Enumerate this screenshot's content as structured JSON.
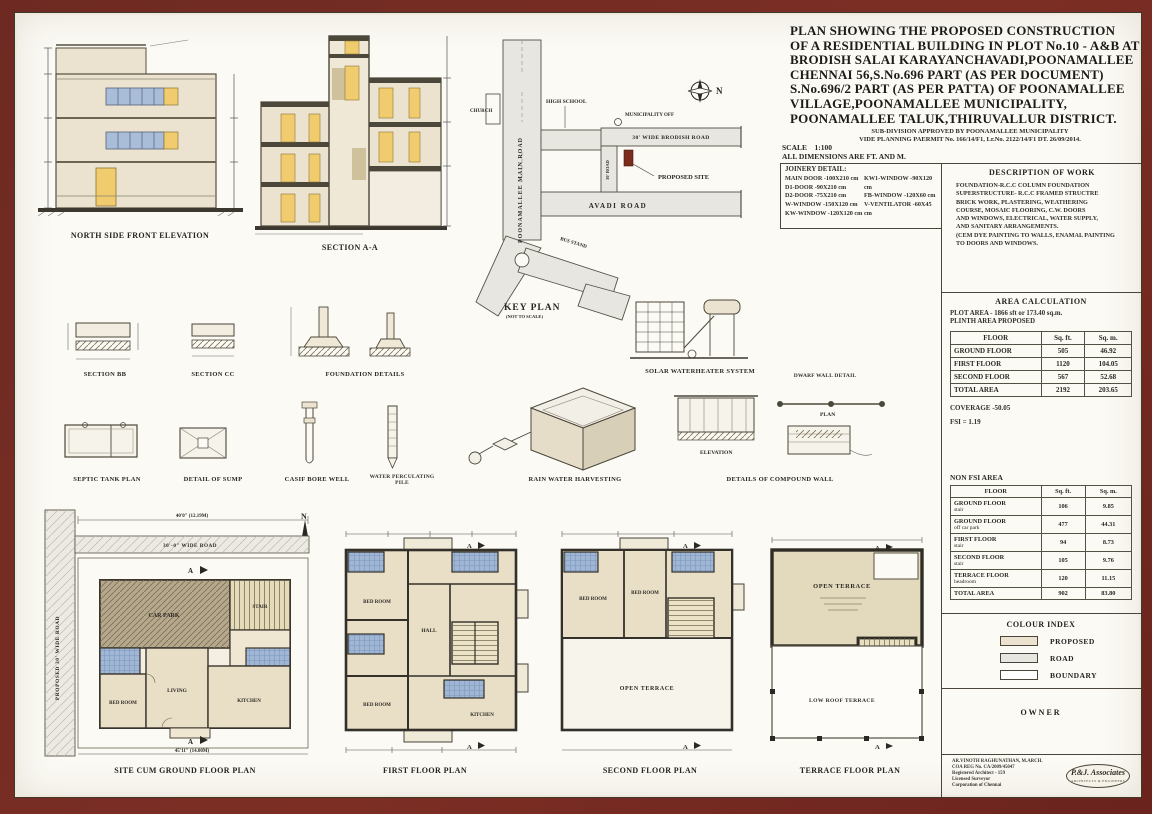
{
  "colors": {
    "frame": "#6e2a22",
    "sheet": "#fbfaf4",
    "cream": "#ebe3cf",
    "window_blue": "#a9bdd9",
    "door_yellow": "#f0cc6e",
    "road_gray": "#e7e6e1",
    "site_marker": "#7c2b1d",
    "room_tan": "#e9dfc6",
    "bath_blue": "#9fb6d4",
    "carpark": "#b5a88c",
    "wall_ink": "#333333"
  },
  "title_block": {
    "title_lines": [
      "PLAN SHOWING THE PROPOSED CONSTRUCTION",
      "OF A RESIDENTIAL BUILDING IN PLOT No.10 - A&B  AT",
      "BRODISH SALAI KARAYANCHAVADI,POONAMALLEE",
      "CHENNAI 56,S.No.696 PART (AS PER DOCUMENT)",
      "S.No.696/2 PART (AS PER PATTA) OF POONAMALLEE",
      "VILLAGE,POONAMALLEE MUNICIPALITY,",
      "POONAMALLEE TALUK,THIRUVALLUR DISTRICT."
    ],
    "subdivision_line1": "SUB-DIVISION APPROVED BY POONAMALLEE MUNICIPALITY",
    "subdivision_line2": "VIDE PLANNING PAERMIT No. 166/14/F1, Lr.No. 2122/14/F1 DT. 26/09/2014.",
    "scale_label": "SCALE",
    "scale_value": "1:100",
    "dims_note": "ALL DIMENSIONS ARE FT. AND M.",
    "joinery": {
      "heading": "JOINERY DETAIL:",
      "left": [
        "MAIN DOOR -100X210 cm",
        "D1-DOOR -90X210 cm",
        "D2-DOOR -75X210 cm",
        "W-WINDOW -150X120 cm",
        "KW-WINDOW -120X120 cm"
      ],
      "right": [
        "KW1-WINDOW -90X120 cm",
        "FB-WINDOW -120X60 cm",
        "V-VENTILATOR -60X45 cm"
      ]
    },
    "description": {
      "heading": "DESCRIPTION OF WORK",
      "lines": [
        "FOUNDATION-R.C.C COLUMN FOUNDATION",
        "SUPERSTRUCTURE- R.C.C FRAMED STRUCTRE",
        "BRICK WORK, PLASTERING, WEATHERING",
        "COURSE, MOSAIC FLOORING, C.W. DOORS",
        "AND WINDOWS, ELECTRICAL, WATER SUPPLY,",
        "AND SANITARY ARRANGEMENTS.",
        "(CEM DYE PAINTING TO WALLS, ENAMAL PAINTING",
        "TO DOORS AND WINDOWS."
      ]
    },
    "area_calc": {
      "heading": "AREA CALCULATION",
      "plot_area": "PLOT AREA - 1866 sft  or 173.40 sq.m.",
      "plinth": "PLINTH AREA PROPOSED",
      "headers": [
        "FLOOR",
        "Sq. ft.",
        "Sq. m."
      ],
      "rows": [
        [
          "GROUND FLOOR",
          "505",
          "46.92"
        ],
        [
          "FIRST FLOOR",
          "1120",
          "104.05"
        ],
        [
          "SECOND FLOOR",
          "567",
          "52.68"
        ],
        [
          "TOTAL AREA",
          "2192",
          "203.65"
        ]
      ],
      "coverage": "COVERAGE -50.05",
      "fsi": "FSI = 1.19"
    },
    "non_fsi": {
      "heading": "NON FSI AREA",
      "headers": [
        "FLOOR",
        "Sq. ft.",
        "Sq. m."
      ],
      "rows": [
        {
          "floor": "GROUND FLOOR",
          "sub": "stair",
          "sqft": "106",
          "sqm": "9.85"
        },
        {
          "floor": "GROUND FLOOR",
          "sub": "off car park",
          "sqft": "477",
          "sqm": "44.31"
        },
        {
          "floor": "FIRST FLOOR",
          "sub": "stair",
          "sqft": "94",
          "sqm": "8.73"
        },
        {
          "floor": "SECOND FLOOR",
          "sub": "stair",
          "sqft": "105",
          "sqm": "9.76"
        },
        {
          "floor": "TERRACE FLOOR",
          "sub": "headroom",
          "sqft": "120",
          "sqm": "11.15"
        },
        {
          "floor": "TOTAL AREA",
          "sub": "",
          "sqft": "902",
          "sqm": "83.80"
        }
      ]
    },
    "colour_index": {
      "heading": "COLOUR INDEX",
      "items": [
        {
          "label": "PROPOSED",
          "color": "#ebe3cf"
        },
        {
          "label": "ROAD",
          "color": "#e7e6e1"
        },
        {
          "label": "BOUNDARY",
          "color": "#ffffff"
        }
      ]
    },
    "owner_heading": "OWNER",
    "architect": {
      "lines": [
        "AR.VINOTH RAGHUNATHAN, M.ARCH.",
        "COA REG No. CA/2009/45047",
        "Registered Architect - 159",
        "Licensed Surveyor",
        "Corporation of Chennai"
      ],
      "logo_text": "P.&J. Associates",
      "logo_sub": "ARCHITECTS & ENGINEERS"
    }
  },
  "drawings": {
    "elevation_label": "NORTH SIDE FRONT ELEVATION",
    "section_aa_label": "SECTION A-A",
    "key_plan": {
      "label": "KEY PLAN",
      "sublabel": "(NOT TO SCALE)",
      "north": "N",
      "road_main": "POONAMALLEE MAIN ROAD",
      "road_avadi": "AVADI ROAD",
      "road_brodish": "30' WIDE BRODISH ROAD",
      "road_cross": "30' ROAD",
      "poi_church": "CHURCH",
      "poi_school": "HIGH SCHOOL",
      "poi_municipality": "MUNICIPALITY OFF",
      "poi_site": "PROPOSED SITE",
      "poi_bus": "BUS STAND"
    },
    "details": {
      "section_bb": "SECTION BB",
      "section_cc": "SECTION CC",
      "foundation": "FOUNDATION DETAILS",
      "solar": "SOLAR WATERHEATER SYSTEM",
      "dwarf_wall": "DWARF WALL DETAIL",
      "septic": "SEPTIC TANK PLAN",
      "sump": "DETAIL OF SUMP",
      "borewell": "CASIF BORE WELL",
      "percolating_1": "WATER PERCULATING",
      "percolating_2": "PILE",
      "rainwater": "RAIN WATER HARVESTING",
      "compound_wall": "DETAILS OF COMPOUND WALL",
      "plan_tag": "PLAN",
      "elevation_tag": "ELEVATION"
    },
    "plans": {
      "north": "N",
      "marker": "A",
      "ground": {
        "label": "SITE CUM GROUND FLOOR PLAN",
        "road_side": "PROPOSED 30' WIDE ROAD",
        "road_top": "30'-0\" WIDE ROAD",
        "dim_top": "40'0\" (12.19M)",
        "dim_bottom": "45'11\" (14.00M)",
        "rooms": {
          "carpark": "CAR PARK",
          "stair": "STAIR",
          "living": "LIVING",
          "bed": "BED ROOM",
          "kitchen": "KITCHEN"
        }
      },
      "first": {
        "label": "FIRST FLOOR PLAN",
        "rooms": {
          "bed1": "BED ROOM",
          "hall": "HALL",
          "bed2": "BED ROOM",
          "kitchen": "KITCHEN"
        }
      },
      "second": {
        "label": "SECOND FLOOR PLAN",
        "rooms": {
          "bed1": "BED ROOM",
          "bed2": "BED ROOM",
          "terrace": "OPEN TERRACE"
        }
      },
      "terrace": {
        "label": "TERRACE FLOOR PLAN",
        "rooms": {
          "open": "OPEN TERRACE",
          "head": "HEAD ROOM",
          "low": "LOW ROOF TERRACE"
        }
      }
    }
  }
}
